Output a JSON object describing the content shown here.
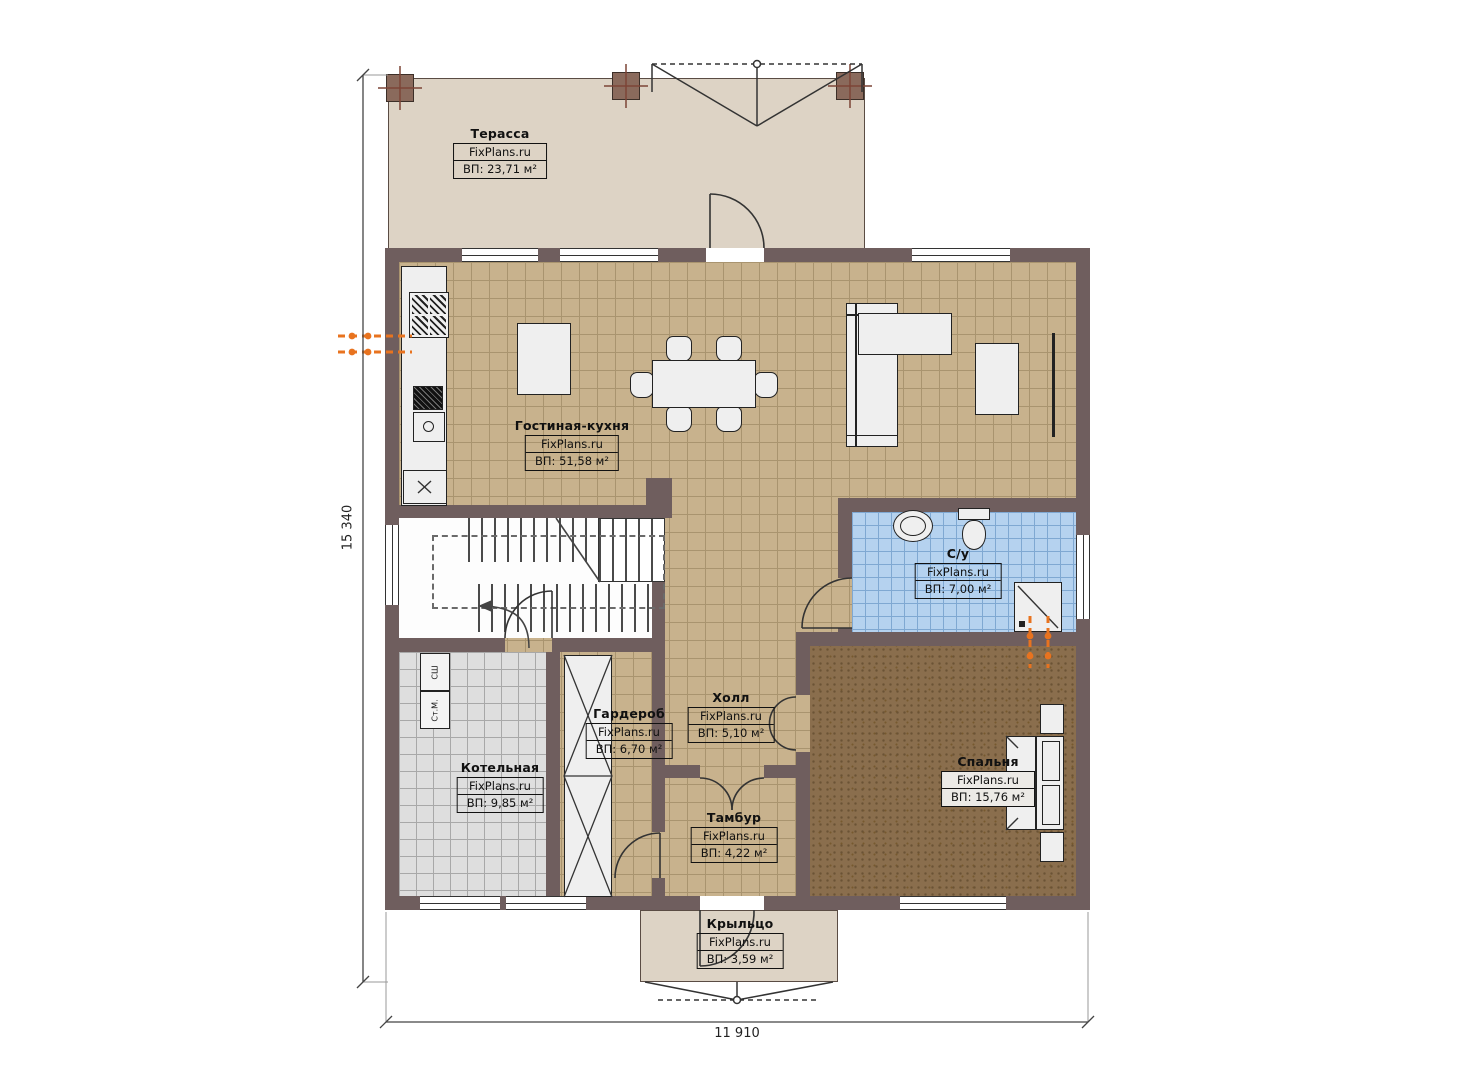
{
  "plan": {
    "brand": "FixPlans.ru",
    "rooms": [
      {
        "id": "terrace",
        "name": "Терасса",
        "area": "ВП: 23,71 м²"
      },
      {
        "id": "living-kitchen",
        "name": "Гостиная-кухня",
        "area": "ВП: 51,58 м²"
      },
      {
        "id": "bathroom",
        "name": "С/у",
        "area": "ВП: 7,00 м²"
      },
      {
        "id": "hall",
        "name": "Холл",
        "area": "ВП: 5,10 м²"
      },
      {
        "id": "wardrobe",
        "name": "Гардероб",
        "area": "ВП: 6,70 м²"
      },
      {
        "id": "boiler",
        "name": "Котельная",
        "area": "ВП: 9,85 м²"
      },
      {
        "id": "vestibule",
        "name": "Тамбур",
        "area": "ВП: 4,22 м²"
      },
      {
        "id": "bedroom",
        "name": "Спальня",
        "area": "ВП: 15,76 м²"
      },
      {
        "id": "porch",
        "name": "Крыльцо",
        "area": "ВП: 3,59 м²"
      }
    ],
    "appliances": {
      "dryer": "СШ",
      "washer": "Ст.М."
    },
    "dimensions": {
      "overall_height_mm": "15 340",
      "overall_width_mm": "11 910"
    },
    "colors": {
      "wall": "#6f5e5e",
      "floor_tile": "#c8b28d",
      "bath_tile": "#b5d2ef",
      "boiler_tile": "#dedede",
      "bedroom_floor": "#8a6e4d",
      "terrace_floor": "#ddd3c5",
      "accent_orange": "#e8731f"
    }
  }
}
